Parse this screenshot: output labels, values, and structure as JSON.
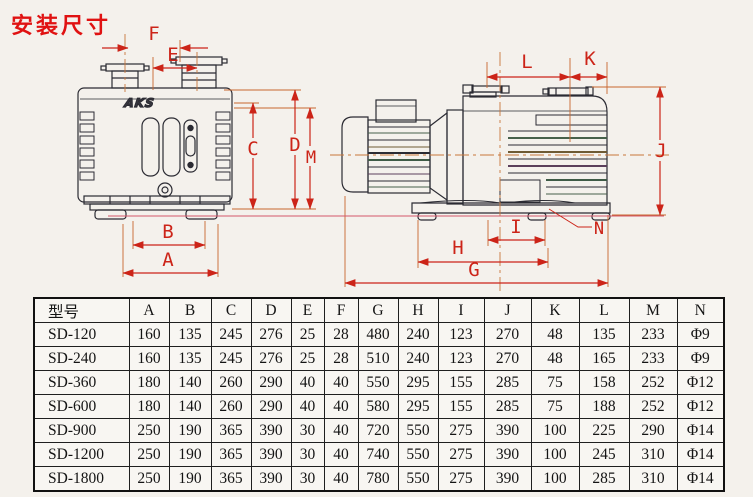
{
  "title": "安装尺寸",
  "colors": {
    "title_red": "#e01212",
    "dimension_red": "#cc2418",
    "extension_orange": "#c8662e",
    "baseline_pink": "#d4566a",
    "line_dark": "#2b2b33"
  },
  "drawing": {
    "logo": "AKS",
    "labels": {
      "A": "A",
      "B": "B",
      "C": "C",
      "D": "D",
      "E": "E",
      "F": "F",
      "G": "G",
      "H": "H",
      "I": "I",
      "J": "J",
      "K": "K",
      "L": "L",
      "M": "M",
      "N": "N"
    }
  },
  "table": {
    "headers": [
      "型号",
      "A",
      "B",
      "C",
      "D",
      "E",
      "F",
      "G",
      "H",
      "I",
      "J",
      "K",
      "L",
      "M",
      "N"
    ],
    "rows": [
      {
        "model": "SD-120",
        "values": [
          "160",
          "135",
          "245",
          "276",
          "25",
          "28",
          "480",
          "240",
          "123",
          "270",
          "48",
          "135",
          "233",
          "Φ9"
        ]
      },
      {
        "model": "SD-240",
        "values": [
          "160",
          "135",
          "245",
          "276",
          "25",
          "28",
          "510",
          "240",
          "123",
          "270",
          "48",
          "165",
          "233",
          "Φ9"
        ]
      },
      {
        "model": "SD-360",
        "values": [
          "180",
          "140",
          "260",
          "290",
          "40",
          "40",
          "550",
          "295",
          "155",
          "285",
          "75",
          "158",
          "252",
          "Φ12"
        ]
      },
      {
        "model": "SD-600",
        "values": [
          "180",
          "140",
          "260",
          "290",
          "40",
          "40",
          "580",
          "295",
          "155",
          "285",
          "75",
          "188",
          "252",
          "Φ12"
        ]
      },
      {
        "model": "SD-900",
        "values": [
          "250",
          "190",
          "365",
          "390",
          "30",
          "40",
          "720",
          "550",
          "275",
          "390",
          "100",
          "225",
          "290",
          "Φ14"
        ]
      },
      {
        "model": "SD-1200",
        "values": [
          "250",
          "190",
          "365",
          "390",
          "30",
          "40",
          "740",
          "550",
          "275",
          "390",
          "100",
          "245",
          "310",
          "Φ14"
        ]
      },
      {
        "model": "SD-1800",
        "values": [
          "250",
          "190",
          "365",
          "390",
          "30",
          "40",
          "780",
          "550",
          "275",
          "390",
          "100",
          "285",
          "310",
          "Φ14"
        ]
      }
    ]
  }
}
